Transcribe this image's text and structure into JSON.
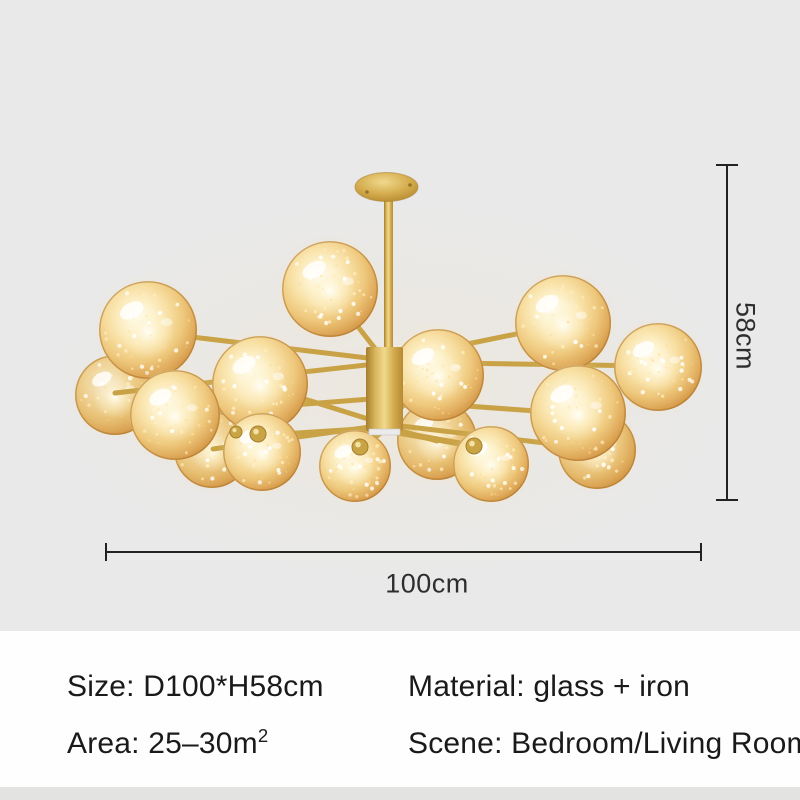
{
  "page": {
    "background_color": "#e9e9e9",
    "panel_background_color": "#fefefe",
    "footer_strip_color": "#e3e3e2"
  },
  "product": {
    "type": "sputnik chandelier with glowing glass globes",
    "visible_globe_count": 15,
    "frame_color": "#c9a445",
    "glass_color": "#e8b96a",
    "glow_color": "#fff6d8"
  },
  "dimensions": {
    "height": "58cm",
    "width": "100cm",
    "line_color": "#222222"
  },
  "specs": {
    "size": "Size: D100*H58cm",
    "material": "Material: glass + iron",
    "area": "Area: 25–30m",
    "area_sup": "2",
    "scene": "Scene: Bedroom/Living Room"
  }
}
